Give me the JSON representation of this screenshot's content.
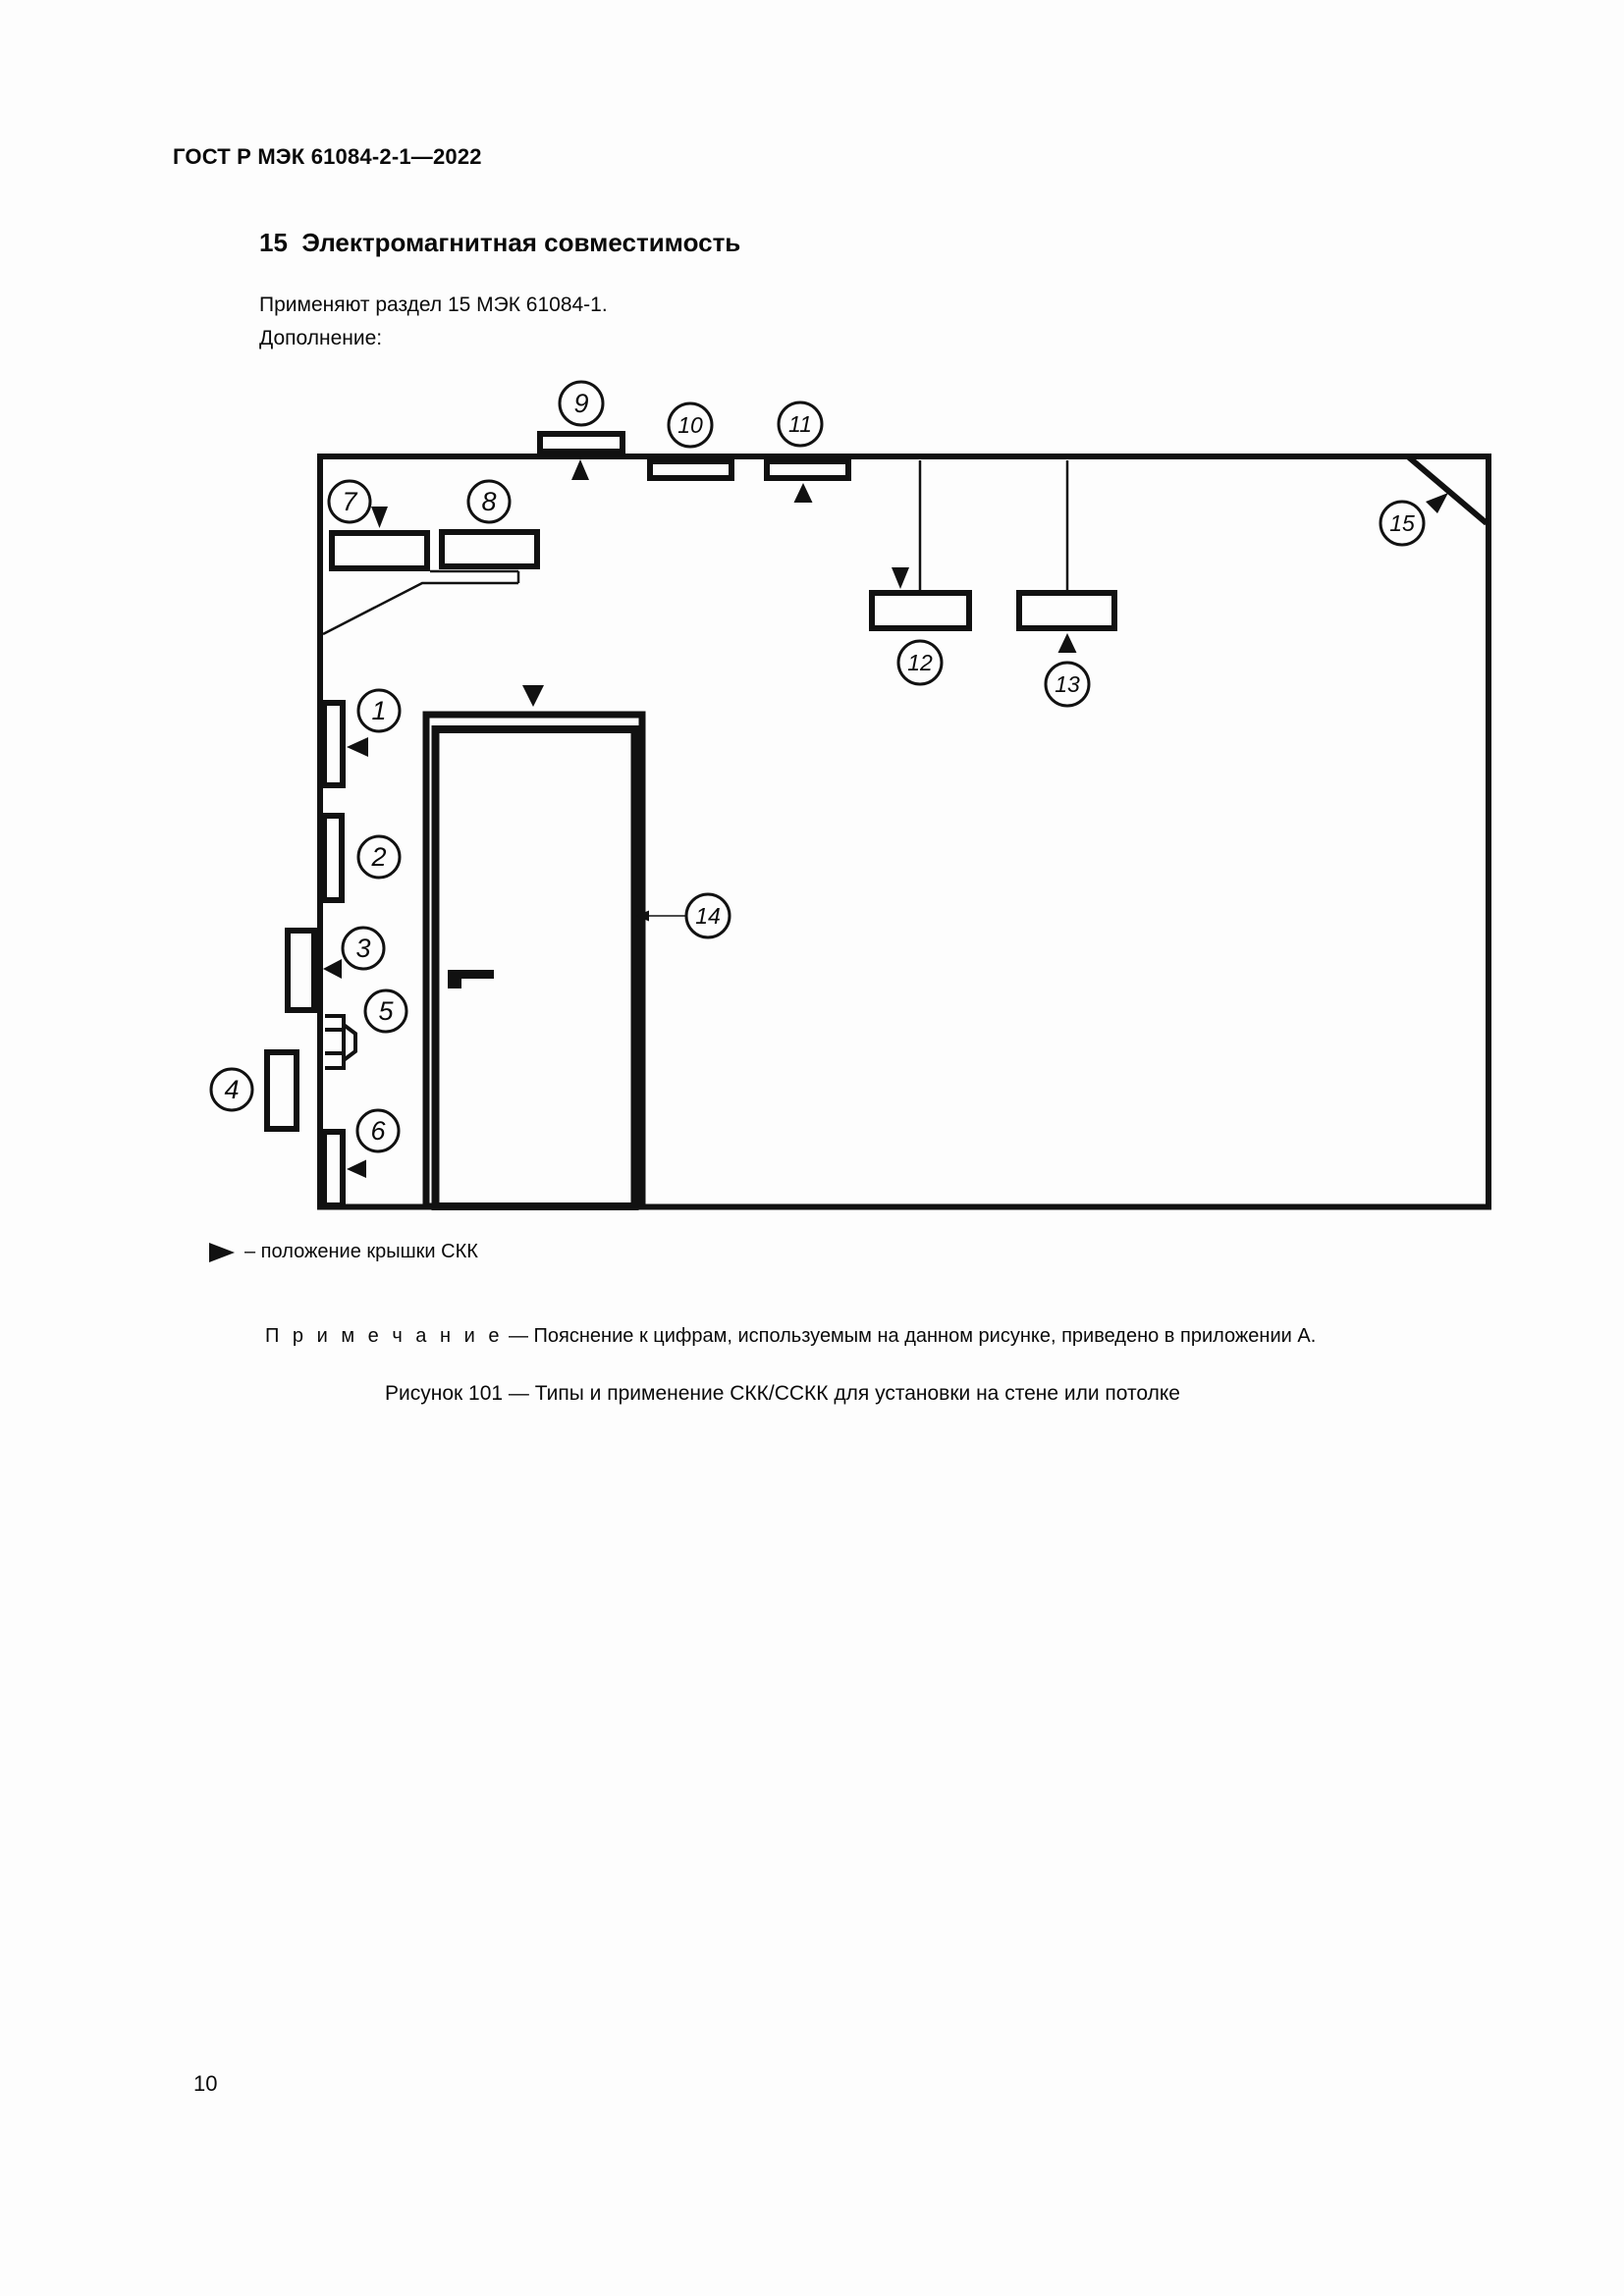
{
  "page": {
    "header": "ГОСТ Р МЭК 61084-2-1—2022",
    "section_heading": "15  Электромагнитная совместимость",
    "paragraph_1": "Применяют раздел 15 МЭК 61084-1.",
    "paragraph_2": "Дополнение:",
    "page_number": "10"
  },
  "figure": {
    "legend_text": "– положение крышки СКК",
    "note_label": "П р и м е ч а н и е",
    "note_text": " — Пояснение к цифрам, используемым на данном рисунке, приведено в приложении А.",
    "caption": "Рисунок 101 — Типы и применение СКК/ССКК для установки на стене или потолке",
    "callouts": [
      "1",
      "2",
      "3",
      "4",
      "5",
      "6",
      "7",
      "8",
      "9",
      "10",
      "11",
      "12",
      "13",
      "14",
      "15"
    ]
  },
  "colors": {
    "ink": "#111111",
    "paper": "#fdfdfd"
  }
}
